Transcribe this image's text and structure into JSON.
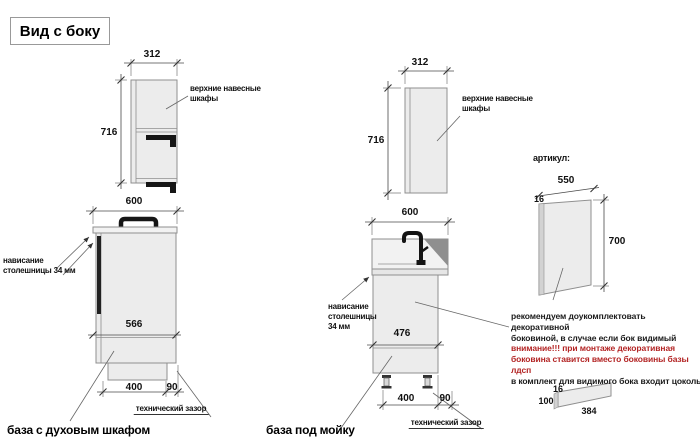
{
  "title": "Вид с боку",
  "colors": {
    "background": "#ffffff",
    "drawing_fill": "#ececec",
    "outline_gray": "#8f8f8f",
    "text_black": "#1a1a1a",
    "warning_red": "#b32424"
  },
  "oven_unit": {
    "wall_cabinet": {
      "width": "312",
      "height": "716",
      "label_lines": [
        "верхние навесные",
        "шкафы"
      ]
    },
    "base": {
      "width": "600",
      "inner_depth": "566",
      "front_span": "400",
      "gap": "90",
      "overhang_lines": [
        "нависание",
        "столешницы 34 мм"
      ],
      "gap_label": "технический зазор",
      "caption": "база с духовым шкафом"
    }
  },
  "sink_unit": {
    "wall_cabinet": {
      "width": "312",
      "height": "716",
      "label_lines": [
        "верхние навесные",
        "шкафы"
      ]
    },
    "base": {
      "width": "600",
      "inner_depth": "476",
      "front_span": "400",
      "gap": "90",
      "overhang_lines": [
        "нависание",
        "столешницы",
        "34 мм"
      ],
      "gap_label": "технический зазор",
      "caption": "база под мойку"
    }
  },
  "side_panel": {
    "heading": "артикул:",
    "width": "550",
    "thickness": "16",
    "height": "700",
    "notes": [
      {
        "text": "рекомендуем доукомплектовать декоративной",
        "emphasis": "normal"
      },
      {
        "text": "боковиной, в случае если бок видимый",
        "emphasis": "normal"
      },
      {
        "text": "внимание!!! при монтаже декоративная",
        "emphasis": "warning"
      },
      {
        "text": "боковина ставится вместо боковины базы лдсп",
        "emphasis": "warning"
      },
      {
        "text": "в комплект для видимого бока входит цоколь:",
        "emphasis": "normal"
      }
    ],
    "plinth": {
      "thickness": "16",
      "height": "100",
      "length": "384"
    }
  }
}
